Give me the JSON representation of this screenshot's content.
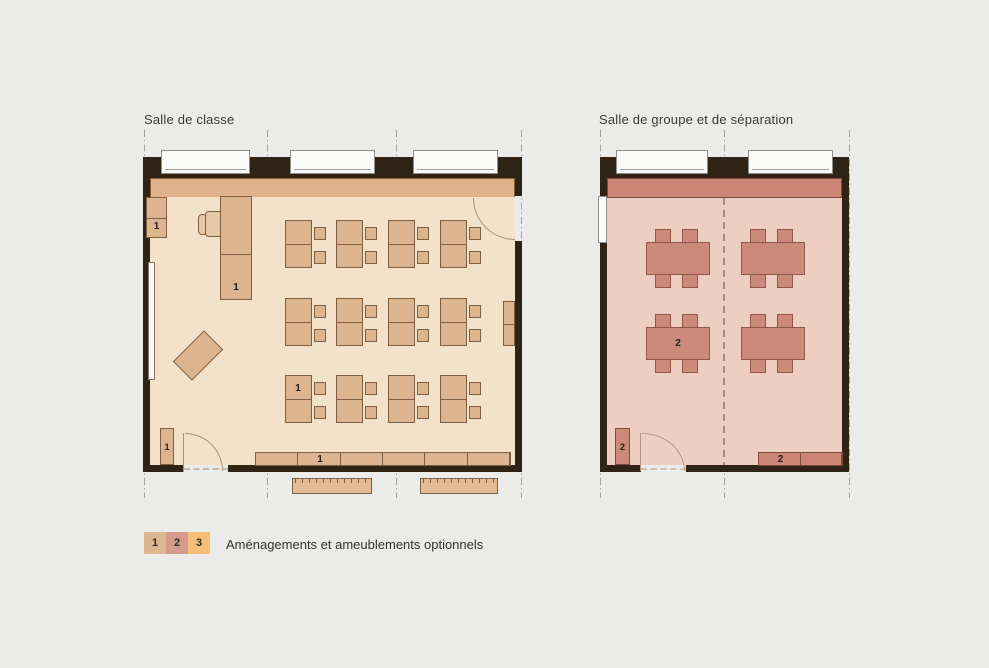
{
  "background_color": "#ebebe9",
  "classroom": {
    "title": "Salle de classe",
    "markers": {
      "cabinet_top_left": "1",
      "teacher_desk": "1",
      "student_desk": "1",
      "cabinet_bottom_left": "1",
      "shelf_row": "1"
    }
  },
  "grouproom": {
    "title": "Salle de groupe et de séparation",
    "markers": {
      "table": "2",
      "cabinet_bottom_left": "2",
      "sideboard": "2"
    }
  },
  "legend": {
    "items": [
      {
        "label": "1",
        "color": "#dcb791"
      },
      {
        "label": "2",
        "color": "#d49c8c"
      },
      {
        "label": "3",
        "color": "#f6be77"
      }
    ],
    "text": "Aménagements et ameublements optionnels"
  },
  "colors": {
    "wall": "#2e2315",
    "classroom_floor": "#f3e1ca",
    "classroom_counter_band": "#dfb28b",
    "classroom_furniture": "#dcb58e",
    "grouproom_floor": "#edcec1",
    "grouproom_counter_band": "#cc8475",
    "grouproom_furniture": "#cb8a7a",
    "grid_line": "#a3a39b"
  }
}
